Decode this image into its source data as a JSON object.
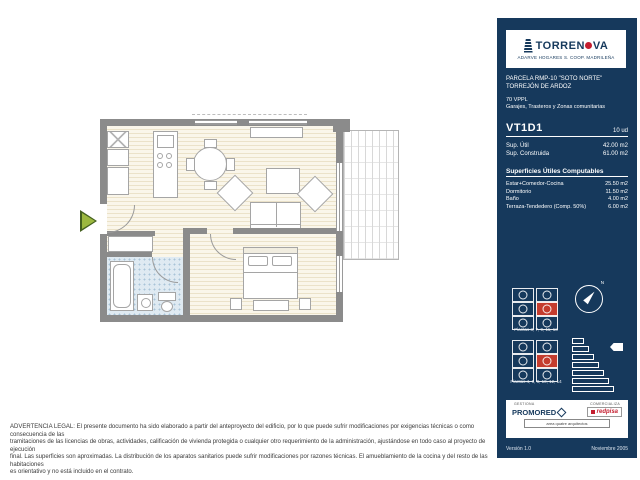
{
  "sidebar": {
    "bg_color": "#16395C",
    "accent_red": "#C41E2F",
    "logo": {
      "brand_prefix": "TORREN",
      "brand_suffix": "VA",
      "subtitle": "ADARVE HOGARES S. COOP. MADRILEÑA"
    },
    "project": {
      "parcel": "PARCELA RMP-10 \"SOTO NORTE\"",
      "city": "TORREJÓN DE ARDOZ",
      "units": "70 VPPL",
      "extras": "Garajes, Trasteros y Zonas comunitarias"
    },
    "unit": {
      "code": "VT1D1",
      "count": "10 ud",
      "areas": [
        {
          "label": "Sup. Útil",
          "value": "42.00 m2"
        },
        {
          "label": "Sup. Construida",
          "value": "61.00 m2"
        }
      ],
      "computable_title": "Superficies Útiles Computables",
      "computable": [
        {
          "label": "Estar+Comedor-Cocina",
          "value": "25.50 m2"
        },
        {
          "label": "Dormitorio",
          "value": "11.50 m2"
        },
        {
          "label": "Baño",
          "value": "4.00 m2"
        },
        {
          "label": "Terraza-Tendedero (Comp. 50%)",
          "value": "6.00 m2"
        }
      ]
    },
    "keyplans": [
      {
        "label": "Plantas 3, 7, 9, 11, 13"
      },
      {
        "label": "Plantas 4, 6, 8, 10, 12, 14"
      }
    ],
    "compass_label": "N",
    "footer": {
      "caption_left": "GESTIONA",
      "caption_right": "COMERCIALIZA",
      "promoter": "PROMORED",
      "agency": "redpisa",
      "architect": "area quatre arquitectos",
      "version": "Versión 1.0",
      "date": "Noviembre 2005"
    }
  },
  "disclaimer": {
    "lines": [
      "ADVERTENCIA LEGAL: El presente documento ha sido elaborado a partir del anteproyecto del edificio, por lo que puede sufrir modificaciones por exigencias técnicas o como consecuencia de las",
      "tramitaciones de las licencias de obras, actividades, calificación de vivienda protegida o cualquier otro requerimiento de la administración, ajustándose en todo caso al proyecto de ejecución",
      "final. Las superficies son aproximadas. La distribución de los aparatos sanitarios puede sufrir modificaciones por razones técnicas. El amueblamiento de la cocina y del resto de las habitaciones",
      "es orientativo y no está incluido en el contrato."
    ]
  }
}
